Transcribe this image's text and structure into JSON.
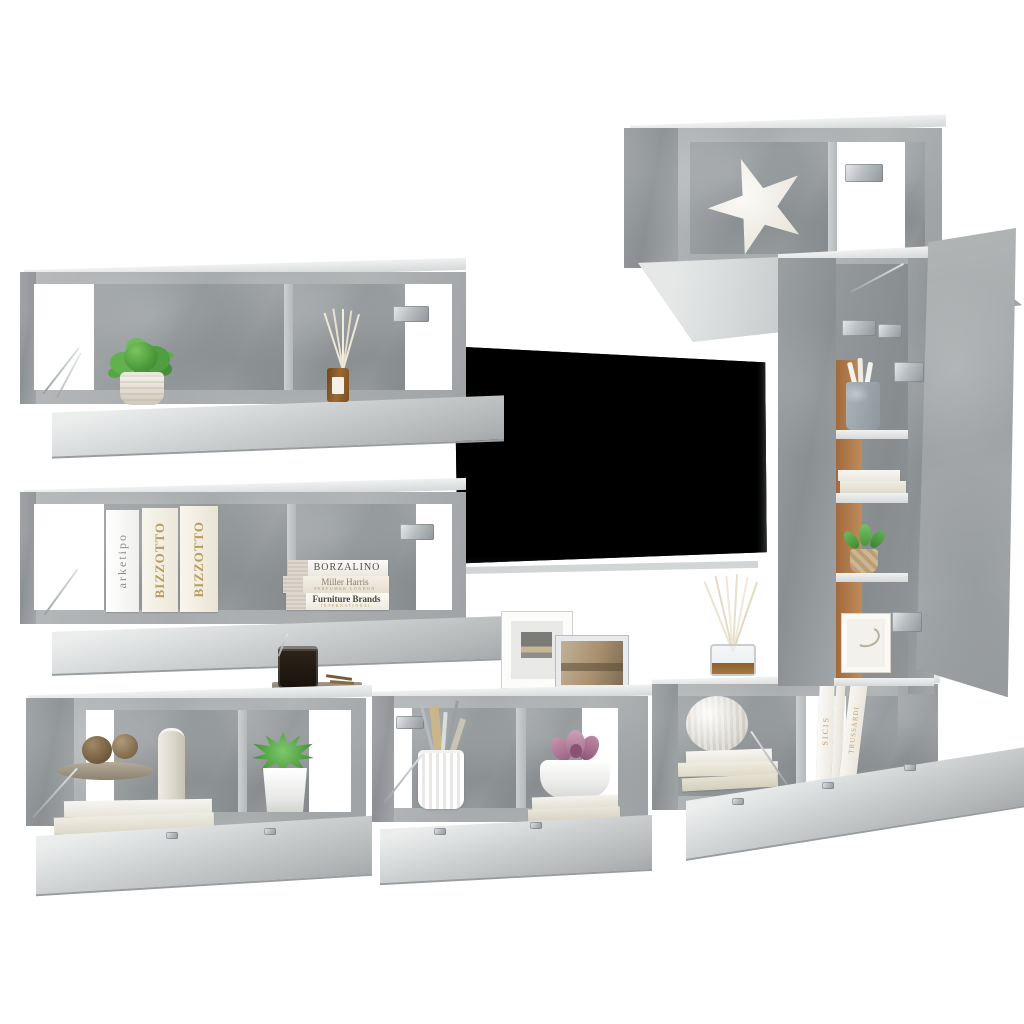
{
  "scene": {
    "background": "#ffffff"
  },
  "palette": {
    "concrete": "#aeb2b4",
    "concrete_dark": "#94999b",
    "concrete_light": "#dcdedf",
    "back_panel_wood": "#b97f50",
    "tv_screen": "#141617",
    "plant_green": "#55a344",
    "succulent_green": "#5faf4f",
    "succulent_purple": "#b07a9a",
    "diffuser_amber": "#8a5a2b",
    "book_cream": "#f3efe4",
    "gold_text": "#b79d5e",
    "metal": "#c3c8ca"
  },
  "texts": {
    "book_arketipo": "arketipo",
    "book_bizzotto_1": "BIZZOTTO",
    "book_bizzotto_2": "BIZZOTTO",
    "stack": [
      {
        "title": "BORZALINO",
        "subtitle": ""
      },
      {
        "title": "Miller Harris",
        "subtitle": "PERFUMER LONDON"
      },
      {
        "title": "Furniture Brands",
        "subtitle": "INTERNATIONAL"
      }
    ],
    "book_sicis": "SICIS",
    "book_trussardi": "TRUSSARDI"
  }
}
